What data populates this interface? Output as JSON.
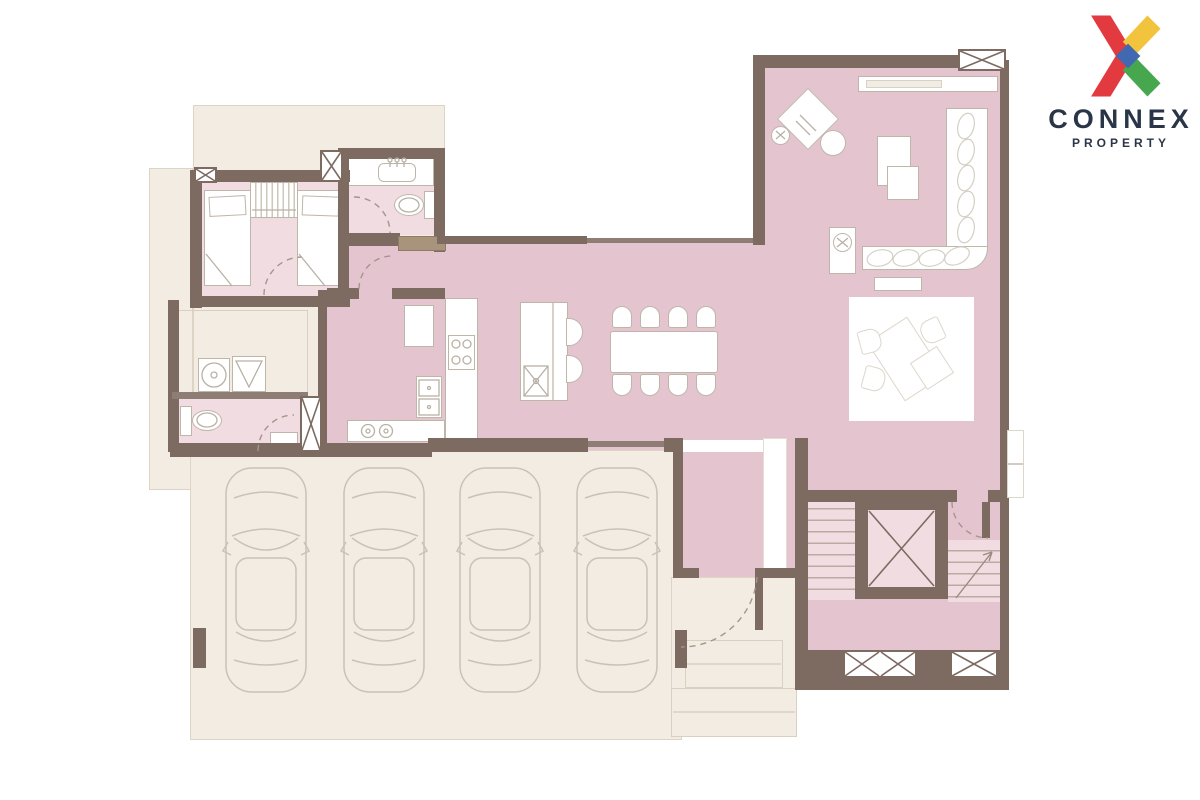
{
  "brand": {
    "name": "CONNEX",
    "tagline": "PROPERTY",
    "logo_colors": {
      "red": "#e23a3e",
      "yellow": "#f2c33c",
      "green": "#47a74f",
      "blue": "#4169b2",
      "text": "#2a3648"
    }
  },
  "palette": {
    "background": "#ffffff",
    "backdrop_beige": "#f2ece2",
    "backdrop_line": "#ddd4c5",
    "wall": "#7d6b62",
    "wall_thin": "#8d7d74",
    "room_pink": "#e4c5cf",
    "room_pink_light": "#f1dce2",
    "furniture_fill": "#ffffff",
    "furniture_stroke": "#bfb6aa",
    "detail_line": "#b9b1a6",
    "cushion_line": "#d6cfc5",
    "arc_line": "#a3968b",
    "tread_line": "#bcaaa2",
    "cabinet_tan": "#a8947c",
    "step_line": "#d9d0c2",
    "car_line": "#c9c2b6"
  },
  "plan": {
    "type": "residential-floor-plan",
    "rooms": [
      "living-room",
      "study-corner",
      "dining-area",
      "kitchen",
      "island-bar",
      "bedroom-twin",
      "bathroom-ensuite",
      "laundry",
      "bathroom-small",
      "foyer",
      "stair-hall-with-elevator",
      "entry-porch",
      "garage"
    ],
    "counts": {
      "garage_cars": 4,
      "dining_chairs": 8,
      "bar_stools": 2,
      "twin_beds": 2,
      "toilets": 2,
      "window_boxes": 6,
      "elevator": 1,
      "staircases": 2
    }
  }
}
